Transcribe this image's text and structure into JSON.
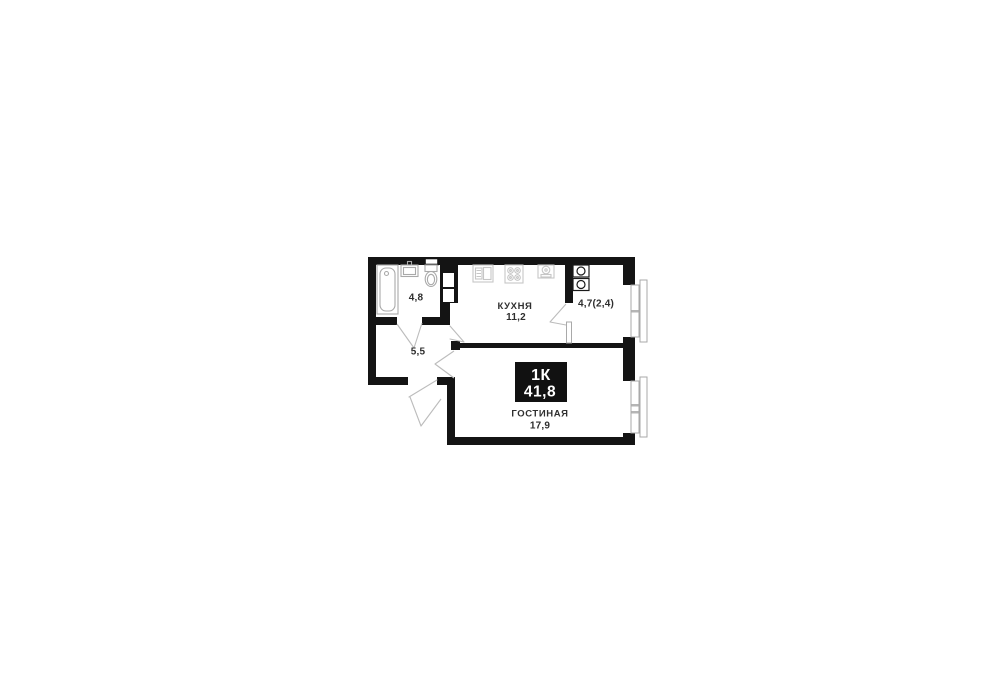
{
  "floor_plan": {
    "badge": {
      "label": "1К",
      "value": "41,8"
    },
    "rooms": {
      "bathroom": {
        "area": "4,8"
      },
      "kitchen": {
        "name": "КУХНЯ",
        "area": "11,2"
      },
      "loggia": {
        "area": "4,7(2,4)"
      },
      "hallway": {
        "area": "5,5"
      },
      "living_room": {
        "name": "ГОСТИНАЯ",
        "area": "17,9"
      }
    },
    "colors": {
      "walls": "#141414",
      "badge_background": "#111111",
      "badge_text": "#ffffff",
      "label_text": "#2f2f2f",
      "fixture_outline": "#a9a9a9",
      "appliance_outline": "#c6c6c6",
      "door_swing": "#bcbcbc",
      "window_frame": "#a9a9a9"
    },
    "icons": [
      "bathtub-icon",
      "washbasin-icon",
      "toilet-icon",
      "vent-shaft-icon",
      "kitchen-sink-icon",
      "stove-icon",
      "water-heater-icon",
      "washer-box-icon",
      "window-icon",
      "door-swing-icon"
    ]
  }
}
